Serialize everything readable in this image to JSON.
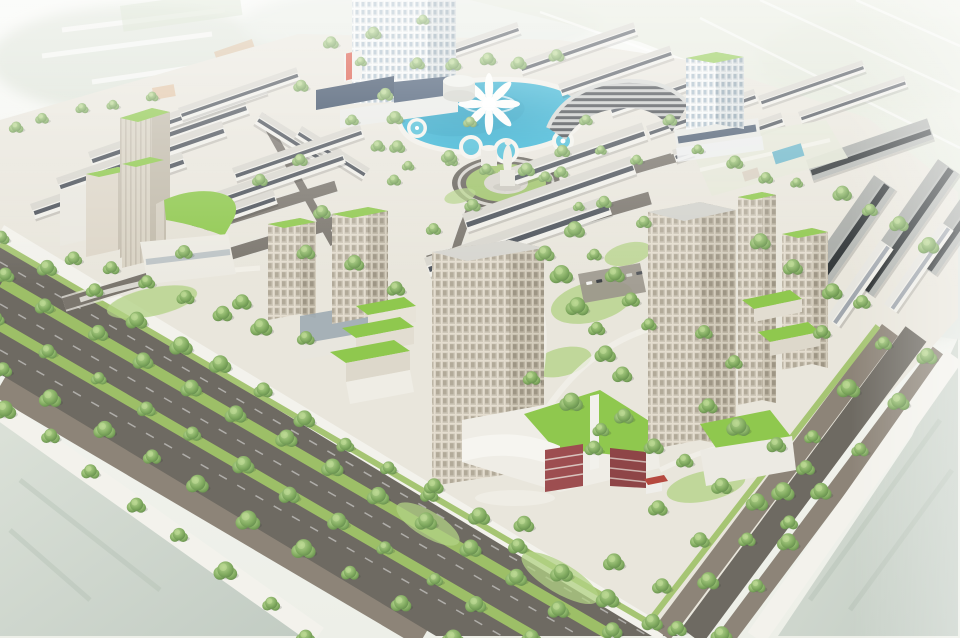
{
  "scene": {
    "subject": "aerial-3d-render-planned-urban-development",
    "colors": {
      "ground": "#e9e6dc",
      "road": "#6e6a62",
      "soil": "#8d8478",
      "walk": "#f3f2ec",
      "median": "#9dbf67",
      "verge": "#a6c573",
      "lawn": "#8fc84e",
      "plaza_green": "#9fc36a",
      "lake": "#2aa9cc",
      "lake_rim": "#49bcd6",
      "maroon_a": "#9d4e50",
      "maroon_b": "#8e4547",
      "navy": "#32455e",
      "navy2": "#3d516b",
      "red_accent": "#d94f3d",
      "kiosk_roof": "#b5493f",
      "orange_faded": "#d7a578",
      "parking": "#9b968c",
      "glass_band": "#9aa7b0"
    },
    "row_styles": {
      "light": {
        "wall": "#f0efe9",
        "strip": "#3f454e",
        "roof": "#d8d6ce"
      },
      "dark": {
        "wall": "#b4b7b3",
        "strip": "#24282b",
        "roof": "#a8aba7"
      },
      "white": {
        "wall": "#f0efe9",
        "strip": "#9aa1a8",
        "roof": "#e6e5df"
      }
    },
    "shophouse_rows": [
      [
        88,
        152,
        165,
        16,
        -19,
        "light"
      ],
      [
        56,
        178,
        175,
        16,
        -19,
        "light"
      ],
      [
        30,
        204,
        160,
        16,
        -19,
        "light"
      ],
      [
        126,
        128,
        145,
        14,
        -19,
        "light"
      ],
      [
        178,
        108,
        125,
        13,
        -19,
        "light"
      ],
      [
        262,
        112,
        82,
        14,
        32,
        "light"
      ],
      [
        302,
        126,
        80,
        13,
        32,
        "light"
      ],
      [
        232,
        168,
        135,
        14,
        -19,
        "light"
      ],
      [
        204,
        196,
        145,
        15,
        -19,
        "light"
      ],
      [
        150,
        232,
        130,
        15,
        -19,
        "light"
      ],
      [
        498,
        172,
        152,
        18,
        -19,
        "light"
      ],
      [
        462,
        214,
        178,
        19,
        -19,
        "light"
      ],
      [
        424,
        258,
        192,
        20,
        -19,
        "light"
      ],
      [
        430,
        52,
        92,
        12,
        -19,
        "light"
      ],
      [
        518,
        62,
        122,
        13,
        -19,
        "light"
      ],
      [
        558,
        84,
        118,
        13,
        -19,
        "light"
      ],
      [
        608,
        104,
        116,
        13,
        -19,
        "light"
      ],
      [
        646,
        126,
        114,
        13,
        -19,
        "light"
      ],
      [
        672,
        150,
        115,
        13,
        -19,
        "light"
      ],
      [
        758,
        96,
        110,
        12,
        -19,
        "light"
      ],
      [
        798,
        112,
        112,
        12,
        -19,
        "light"
      ],
      [
        788,
        298,
        150,
        26,
        -55,
        "dark"
      ],
      [
        852,
        282,
        150,
        26,
        -55,
        "dark"
      ],
      [
        916,
        262,
        130,
        24,
        -55,
        "dark"
      ],
      [
        806,
        160,
        128,
        22,
        -19,
        "dark"
      ],
      [
        826,
        318,
        95,
        16,
        -55,
        "white"
      ],
      [
        884,
        304,
        100,
        15,
        -55,
        "white"
      ]
    ],
    "trees": {
      "rows": [
        [
          6,
          240,
          648,
          622,
          16,
          1.0
        ],
        [
          2,
          276,
          608,
          634,
          14,
          0.95
        ],
        [
          0,
          322,
          528,
          636,
          12,
          0.95
        ],
        [
          2,
          368,
          452,
          636,
          10,
          1.05
        ],
        [
          8,
          406,
          310,
          634,
          8,
          1.0
        ],
        [
          676,
          632,
          888,
          344,
          7,
          1.0
        ],
        [
          718,
          636,
          930,
          354,
          7,
          0.95
        ],
        [
          388,
          94,
          396,
          148,
          3,
          0.75
        ],
        [
          412,
          162,
          560,
          170,
          5,
          0.75
        ],
        [
          420,
          66,
          556,
          58,
          5,
          0.7
        ],
        [
          566,
          148,
          636,
          158,
          3,
          0.7
        ],
        [
          548,
          252,
          622,
          378,
          6,
          1.0
        ],
        [
          578,
          228,
          648,
          326,
          5,
          0.9
        ],
        [
          532,
          382,
          606,
          428,
          3,
          1.0
        ],
        [
          652,
          446,
          786,
          520,
          5,
          1.05
        ],
        [
          706,
          402,
          806,
          468,
          4,
          1.0
        ],
        [
          72,
          258,
          302,
          340,
          7,
          1.0
        ],
        [
          448,
          158,
          474,
          204,
          2,
          0.7
        ],
        [
          542,
          176,
          578,
          204,
          2,
          0.7
        ],
        [
          332,
          42,
          424,
          22,
          3,
          0.7
        ],
        [
          298,
          82,
          362,
          62,
          2,
          0.7
        ],
        [
          702,
          152,
          792,
          186,
          4,
          0.75
        ],
        [
          842,
          192,
          932,
          242,
          4,
          0.9
        ],
        [
          762,
          242,
          832,
          292,
          3,
          0.9
        ],
        [
          12,
          124,
          152,
          100,
          5,
          0.75
        ],
        [
          356,
          262,
          398,
          288,
          2,
          0.85
        ],
        [
          398,
          182,
          432,
          228,
          2,
          0.8
        ]
      ],
      "singles": [
        [
          322,
          212,
          0.9
        ],
        [
          306,
          252,
          0.95
        ],
        [
          242,
          302,
          1.0
        ],
        [
          184,
          252,
          0.9
        ],
        [
          434,
          486,
          1.0
        ],
        [
          524,
          524,
          1.05
        ],
        [
          614,
          562,
          1.1
        ],
        [
          662,
          586,
          1.0
        ],
        [
          470,
          122,
          0.7
        ],
        [
          604,
          202,
          0.8
        ],
        [
          644,
          222,
          0.8
        ],
        [
          704,
          332,
          0.9
        ],
        [
          734,
          362,
          0.9
        ],
        [
          822,
          332,
          0.9
        ],
        [
          862,
          302,
          0.9
        ],
        [
          352,
          120,
          0.7
        ],
        [
          378,
          146,
          0.75
        ],
        [
          300,
          160,
          0.8
        ],
        [
          260,
          180,
          0.8
        ],
        [
          624,
          416,
          1.0
        ],
        [
          594,
          448,
          0.95
        ],
        [
          658,
          508,
          1.0
        ],
        [
          700,
          540,
          1.0
        ],
        [
          586,
          120,
          0.7
        ],
        [
          670,
          120,
          0.75
        ]
      ]
    },
    "cars": [
      [
        586,
        282,
        "#f5f5f2"
      ],
      [
        596,
        280,
        "#3c4044"
      ],
      [
        606,
        278,
        "#a63a36"
      ],
      [
        616,
        276,
        "#4a6d8c"
      ],
      [
        626,
        274,
        "#d8d8d2"
      ],
      [
        636,
        272,
        "#55585c"
      ]
    ]
  }
}
